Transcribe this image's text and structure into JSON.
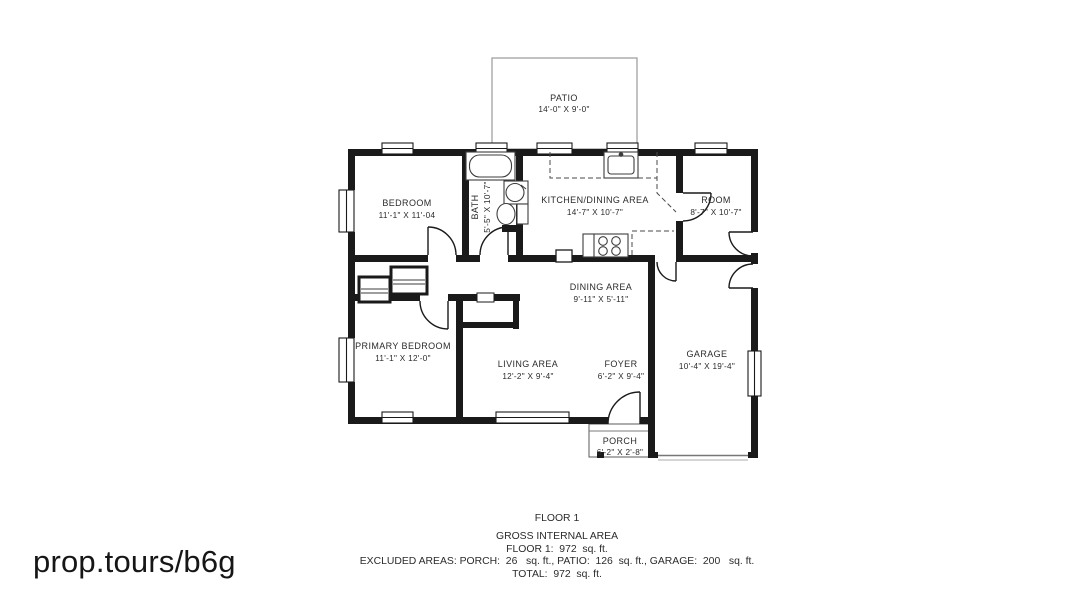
{
  "plan": {
    "rooms": {
      "patio": {
        "name": "PATIO",
        "dims": "14'-0\" X 9'-0\""
      },
      "bedroom": {
        "name": "BEDROOM",
        "dims": "11'-1\" X 11'-04"
      },
      "bath": {
        "name": "BATH",
        "dims": "5'-5\" X 10'-7\""
      },
      "kitchen_dining": {
        "name": "KITCHEN/DINING AREA",
        "dims": "14'-7\" X 10'-7\""
      },
      "room": {
        "name": "ROOM",
        "dims": "8'-7\" X 10'-7\""
      },
      "dining": {
        "name": "DINING AREA",
        "dims": "9'-11\" X 5'-11\""
      },
      "primary_bedroom": {
        "name": "PRIMARY BEDROOM",
        "dims": "11'-1\" X 12'-0\""
      },
      "living": {
        "name": "LIVING AREA",
        "dims": "12'-2\" X 9'-4\""
      },
      "foyer": {
        "name": "FOYER",
        "dims": "6'-2\" X 9'-4\""
      },
      "garage": {
        "name": "GARAGE",
        "dims": "10'-4\" X 19'-4\""
      },
      "porch": {
        "name": "PORCH",
        "dims": "6'-2\" X 2'-8\""
      }
    },
    "colors": {
      "wall": "#1a1a1a",
      "thin_line": "#8f8f8f",
      "label": "#2b2b2b"
    }
  },
  "footer": {
    "title": "FLOOR 1",
    "subtitle": "GROSS INTERNAL AREA",
    "floor1_line": "FLOOR 1:  972  sq. ft.",
    "excluded_line": "EXCLUDED AREAS: PORCH:  26   sq. ft., PATIO:  126  sq. ft., GARAGE:  200   sq. ft.",
    "total_line": "TOTAL:  972  sq. ft."
  },
  "watermark": {
    "text": "prop.tours/b6g"
  }
}
